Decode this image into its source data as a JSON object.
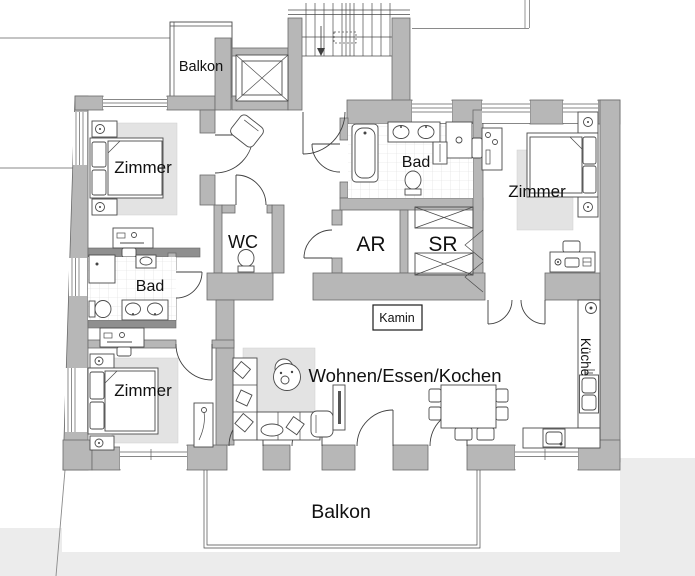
{
  "plan": {
    "labels": {
      "balkon_top": "Balkon",
      "zimmer_top_left": "Zimmer",
      "bad_left": "Bad",
      "zimmer_bottom_left": "Zimmer",
      "wc": "WC",
      "bad_right": "Bad",
      "ar": "AR",
      "sr": "SR",
      "zimmer_right": "Zimmer",
      "kamin": "Kamin",
      "wohnen": "Wohnen/Essen/Kochen",
      "kueche": "Küche",
      "balkon_bottom": "Balkon"
    },
    "colors": {
      "wall": "#b7b7b7",
      "wall_dark": "#8f8f8f",
      "rug": "#e3e3e3",
      "outside": "#ececec",
      "label": "#111111"
    }
  }
}
